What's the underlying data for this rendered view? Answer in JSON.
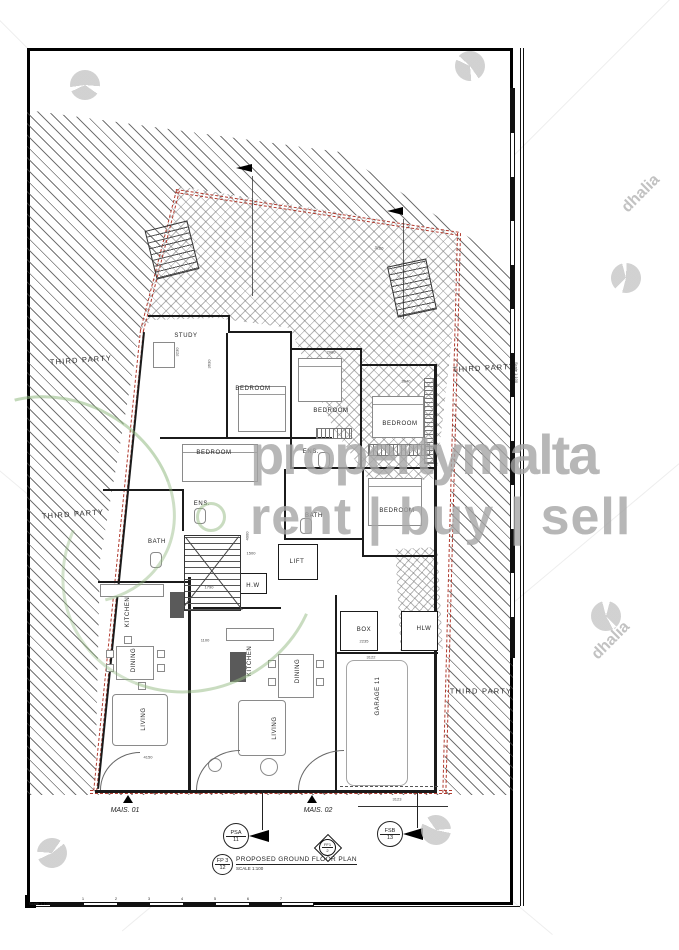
{
  "drawing": {
    "title": "PROPOSED GROUND FLOOR PLAN",
    "title_scale": "SCALE 1:100",
    "sheet_circle": {
      "line1": "FP 3",
      "line2": "12"
    },
    "scalebar_label": "Scale 1:100",
    "scalebar_ticks": [
      "1",
      "2",
      "3",
      "4",
      "5",
      "6",
      "7"
    ],
    "ruler_label": "Scale 1:100"
  },
  "units": {
    "mais_01": "MAIS. 01",
    "mais_02": "MAIS. 02"
  },
  "markers": {
    "psa": {
      "line1": "PSA",
      "line2": "11"
    },
    "ff1": {
      "line1": "FF1",
      "line2": "2"
    },
    "fsb": {
      "line1": "FSB",
      "line2": "13"
    }
  },
  "third_party_labels": [
    {
      "text": "THIRD PARTY",
      "x": 81,
      "y": 360,
      "rot": -4
    },
    {
      "text": "THIRD PARTY",
      "x": 73,
      "y": 514,
      "rot": -4
    },
    {
      "text": "THIRD PARTY",
      "x": 484,
      "y": 368,
      "rot": -3
    },
    {
      "text": "THIRD PARTY",
      "x": 481,
      "y": 691,
      "rot": 0
    }
  ],
  "room_labels": [
    {
      "text": "STUDY",
      "x": 186,
      "y": 336,
      "rot": 0
    },
    {
      "text": "BEDROOM",
      "x": 253,
      "y": 389,
      "rot": 0
    },
    {
      "text": "BEDROOM",
      "x": 331,
      "y": 411,
      "rot": 0
    },
    {
      "text": "BEDROOM",
      "x": 400,
      "y": 424,
      "rot": 0
    },
    {
      "text": "BEDROOM",
      "x": 214,
      "y": 453,
      "rot": 0
    },
    {
      "text": "ENS.",
      "x": 311,
      "y": 452,
      "rot": 0
    },
    {
      "text": "ENS.",
      "x": 202,
      "y": 504,
      "rot": 0
    },
    {
      "text": "BATH",
      "x": 314,
      "y": 516,
      "rot": 0
    },
    {
      "text": "BEDROOM",
      "x": 397,
      "y": 511,
      "rot": 0
    },
    {
      "text": "BATH",
      "x": 157,
      "y": 542,
      "rot": 0
    },
    {
      "text": "LIFT",
      "x": 297,
      "y": 562,
      "rot": 0
    },
    {
      "text": "H.W",
      "x": 253,
      "y": 586,
      "rot": 0
    },
    {
      "text": "KITCHEN",
      "x": 128,
      "y": 612,
      "rot": -90
    },
    {
      "text": "DINING",
      "x": 134,
      "y": 660,
      "rot": -90
    },
    {
      "text": "LIVING",
      "x": 144,
      "y": 719,
      "rot": -90
    },
    {
      "text": "KITCHEN",
      "x": 250,
      "y": 661,
      "rot": -90
    },
    {
      "text": "DINING",
      "x": 298,
      "y": 671,
      "rot": -90
    },
    {
      "text": "LIVING",
      "x": 275,
      "y": 728,
      "rot": -90
    },
    {
      "text": "BOX",
      "x": 364,
      "y": 630,
      "rot": 0
    },
    {
      "text": "HLW",
      "x": 424,
      "y": 629,
      "rot": 0
    },
    {
      "text": "GARAGE 11",
      "x": 378,
      "y": 696,
      "rot": -90
    }
  ],
  "dim_labels": [
    {
      "text": "3100",
      "x": 379,
      "y": 248,
      "rot": 8
    },
    {
      "text": "3230",
      "x": 177,
      "y": 352,
      "rot": -90
    },
    {
      "text": "3630",
      "x": 209,
      "y": 364,
      "rot": -90
    },
    {
      "text": "2980",
      "x": 331,
      "y": 352,
      "rot": 0
    },
    {
      "text": "3040",
      "x": 406,
      "y": 381,
      "rot": 0
    },
    {
      "text": "3110",
      "x": 434,
      "y": 420,
      "rot": -90
    },
    {
      "text": "4000",
      "x": 247,
      "y": 536,
      "rot": -90
    },
    {
      "text": "1500",
      "x": 251,
      "y": 553,
      "rot": 0
    },
    {
      "text": "1790",
      "x": 209,
      "y": 587,
      "rot": 0
    },
    {
      "text": "1100",
      "x": 205,
      "y": 640,
      "rot": 0
    },
    {
      "text": "2235",
      "x": 364,
      "y": 641,
      "rot": 0
    },
    {
      "text": "3122",
      "x": 371,
      "y": 657,
      "rot": 0
    },
    {
      "text": "4150",
      "x": 148,
      "y": 757,
      "rot": 0
    },
    {
      "text": "3123",
      "x": 397,
      "y": 799,
      "rot": 0
    }
  ],
  "watermarks": {
    "brand": "propertymalta",
    "tagline": "rent | buy | sell",
    "agency": "dhalia",
    "agency_text_positions": [
      {
        "x": 618,
        "y": 185
      },
      {
        "x": 588,
        "y": 632
      }
    ],
    "agency_marks": [
      {
        "x": 85,
        "y": 85
      },
      {
        "x": 470,
        "y": 66
      },
      {
        "x": 626,
        "y": 278
      },
      {
        "x": 52,
        "y": 853
      },
      {
        "x": 436,
        "y": 830
      },
      {
        "x": 606,
        "y": 616
      }
    ]
  },
  "colors": {
    "boundary_red": "#b03a2e",
    "wall": "#1b1b1b",
    "watermark_gray": "#a6a6a6",
    "leaf_green": "#93ba81"
  }
}
